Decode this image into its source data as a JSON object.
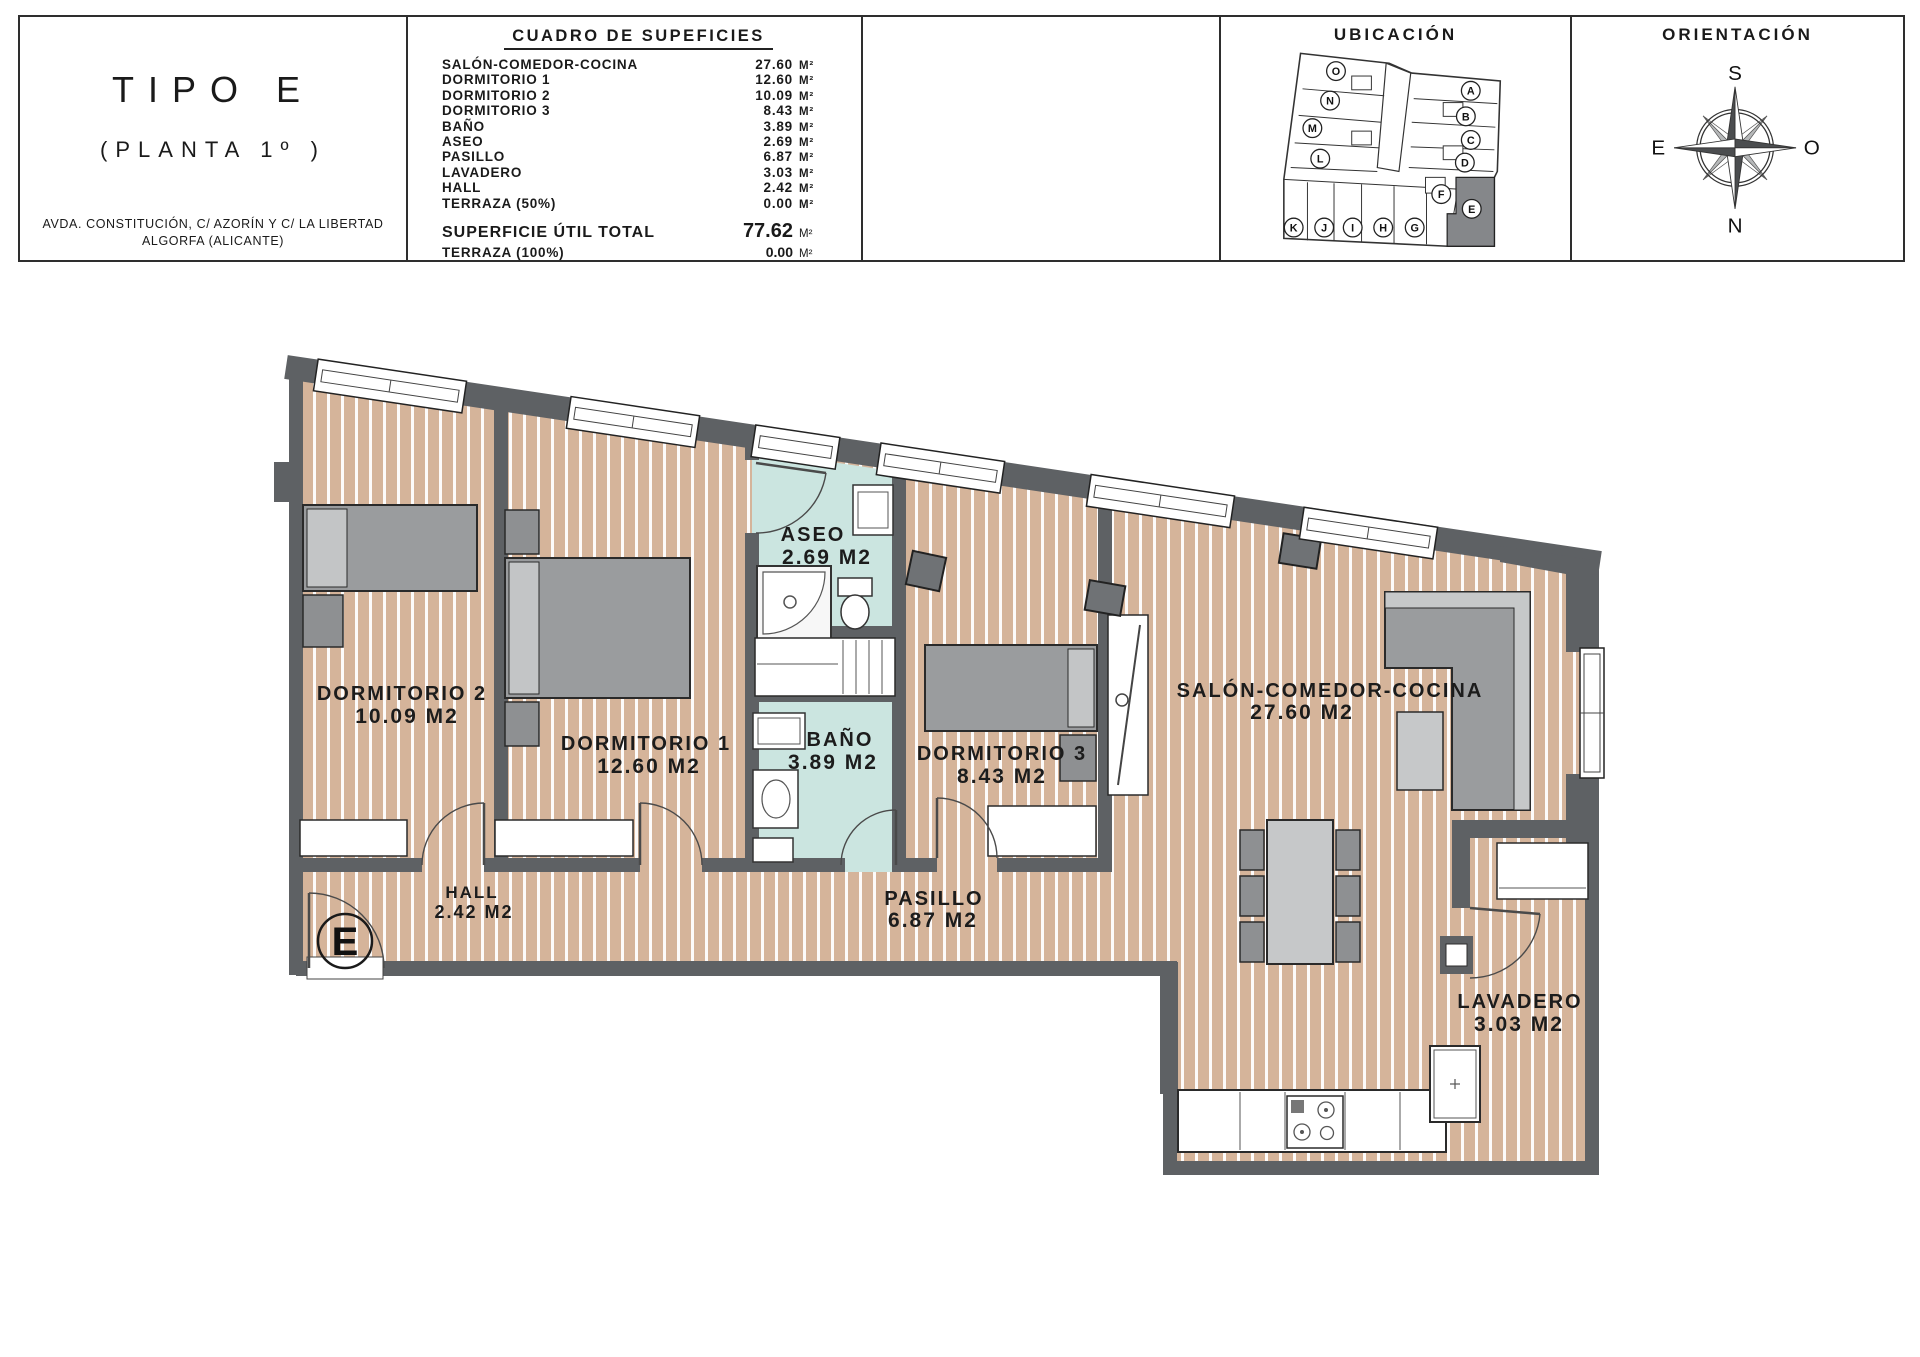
{
  "header": {
    "title_block": {
      "title": "TIPO E",
      "subtitle": "(PLANTA 1º )",
      "address_line1": "AVDA. CONSTITUCIÓN, C/ AZORÍN Y C/ LA LIBERTAD",
      "address_line2": "ALGORFA (ALICANTE)"
    },
    "surface_table": {
      "title": "CUADRO DE SUPEFICIES",
      "unit": "M²",
      "rows": [
        {
          "label": "SALÓN-COMEDOR-COCINA",
          "value": "27.60"
        },
        {
          "label": "DORMITORIO 1",
          "value": "12.60"
        },
        {
          "label": "DORMITORIO 2",
          "value": "10.09"
        },
        {
          "label": "DORMITORIO 3",
          "value": "8.43"
        },
        {
          "label": "BAÑO",
          "value": "3.89"
        },
        {
          "label": "ASEO",
          "value": "2.69"
        },
        {
          "label": "PASILLO",
          "value": "6.87"
        },
        {
          "label": "LAVADERO",
          "value": "3.03"
        },
        {
          "label": "HALL",
          "value": "2.42"
        },
        {
          "label": "TERRAZA (50%)",
          "value": "0.00"
        }
      ],
      "total": {
        "label": "SUPERFICIE ÚTIL TOTAL",
        "value": "77.62"
      },
      "terraza_total": {
        "label": "TERRAZA (100%)",
        "value": "0.00"
      }
    },
    "ubicacion": {
      "title": "UBICACIÓN",
      "units": [
        "O",
        "N",
        "M",
        "L",
        "A",
        "B",
        "C",
        "D",
        "F",
        "E",
        "K",
        "J",
        "I",
        "H",
        "G"
      ],
      "highlighted_unit": "E"
    },
    "orientacion": {
      "title": "ORIENTACIÓN",
      "top": "S",
      "bottom": "N",
      "left": "E",
      "right": "O"
    }
  },
  "floor_plan": {
    "entrance_label": "E",
    "rooms": [
      {
        "name": "DORMITORIO 2",
        "area": "10.09 M2"
      },
      {
        "name": "DORMITORIO 1",
        "area": "12.60 M2"
      },
      {
        "name": "ASEO",
        "area": "2.69 M2"
      },
      {
        "name": "BAÑO",
        "area": "3.89 M2"
      },
      {
        "name": "DORMITORIO 3",
        "area": "8.43 M2"
      },
      {
        "name": "SALÓN-COMEDOR-COCINA",
        "area": "27.60 M2"
      },
      {
        "name": "HALL",
        "area": "2.42 M2"
      },
      {
        "name": "PASILLO",
        "area": "6.87 M2"
      },
      {
        "name": "LAVADERO",
        "area": "3.03 M2"
      }
    ],
    "colors": {
      "wall": "#5e6164",
      "floor": "#d5b49a",
      "wet_floor": "#cbe5e0",
      "accent_dark": "#85878a"
    }
  }
}
